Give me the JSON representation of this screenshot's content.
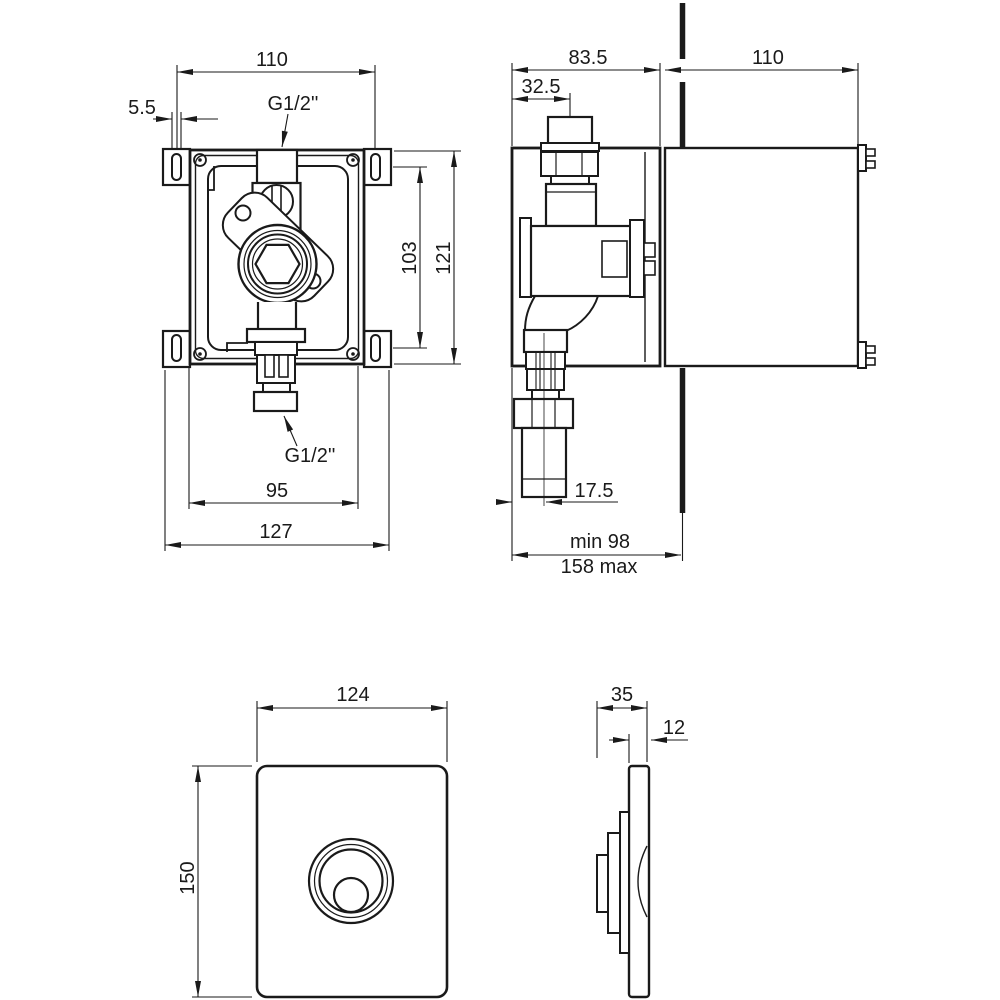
{
  "document": {
    "type": "technical installation drawing",
    "background_color": "#ffffff",
    "line_color": "#1a1a1a"
  },
  "box_front_view": {
    "dim_slot_spacing_h": "110",
    "dim_slot_width": "5.5",
    "label_top_connection": "G1/2''",
    "dim_hole_spacing_v": "103",
    "dim_box_height": "121",
    "label_bottom_connection": "G1/2''",
    "dim_body_width": "95",
    "dim_overall_width": "127"
  },
  "box_side_view": {
    "dim_box_depth": "83.5",
    "dim_inlet_offset": "32.5",
    "dim_cover_depth": "110",
    "dim_outlet_offset": "17.5",
    "dim_install_depth_min": "min 98",
    "dim_install_depth_max": "158 max"
  },
  "plate_front_view": {
    "dim_width": "124",
    "dim_height": "150"
  },
  "plate_side_view": {
    "dim_depth": "35",
    "dim_plate_thickness": "12"
  }
}
